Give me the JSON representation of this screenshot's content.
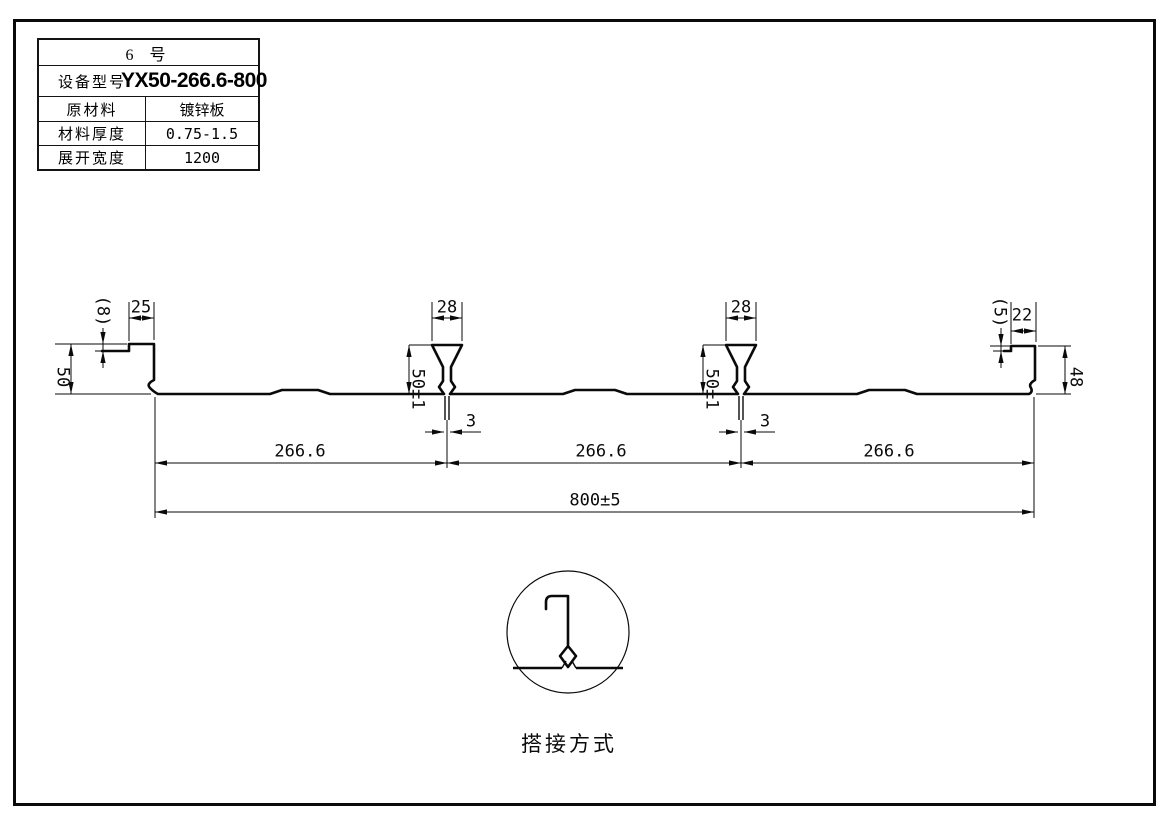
{
  "info_table": {
    "title": "6  号",
    "rows": [
      {
        "label": "设备型号",
        "value": "YX50-266.6-800"
      },
      {
        "label": "原材料",
        "value": "镀锌板"
      },
      {
        "label": "材料厚度",
        "value": "0.75-1.5"
      },
      {
        "label": "展开宽度",
        "value": "1200"
      }
    ]
  },
  "drawing": {
    "dimensions": {
      "left_lip_drop": "(8)",
      "left_top_flange": "25",
      "left_height": "50",
      "rib1_top_width": "28",
      "rib1_height": "50±1",
      "rib1_stem_width": "3",
      "rib2_top_width": "28",
      "rib2_height": "50±1",
      "rib2_stem_width": "3",
      "right_lip_drop": "(5)",
      "right_top_flange": "22",
      "right_height": "48",
      "span1": "266.6",
      "span2": "266.6",
      "span3": "266.6",
      "total_width": "800±5"
    },
    "detail_caption": "搭接方式",
    "colors": {
      "line": "#0a0a0a",
      "background": "#ffffff"
    }
  }
}
